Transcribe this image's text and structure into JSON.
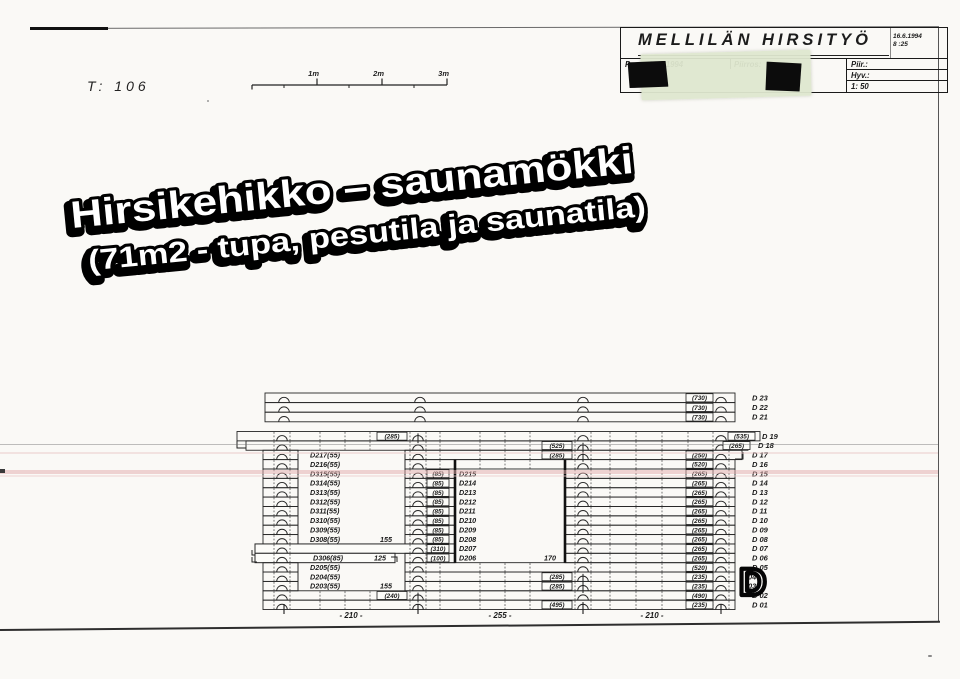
{
  "header": {
    "t_label": "T:  106",
    "scale_bar": {
      "labels": [
        "1m",
        "2m",
        "3m"
      ]
    },
    "title_block": {
      "company": "MELLILÄN HIRSITYÖ",
      "date": "16.6.1994",
      "time": "8 :25",
      "pvm_label": "Pvm.: 16.6.1994",
      "piirros_label": "Piirros:",
      "piir_label": "Piir.:",
      "hyv_label": "Hyv.:",
      "scale_label": "1: 50"
    }
  },
  "big_title": {
    "line1": "Hirsikehikko – saunamökki",
    "line2": "(71m2 - tupa, pesutila ja saunatila)"
  },
  "drawing": {
    "block": {
      "top": 431.5,
      "row_h": 9.37,
      "left": 263,
      "right": 735
    },
    "top_rows": {
      "top": 393,
      "row_h": 9.6,
      "left": 265,
      "right": 735,
      "arc_cols": [
        284,
        420,
        583,
        721
      ],
      "box_x": 686,
      "label_x": 752,
      "rows": [
        {
          "box": "(730)",
          "label": "D 23"
        },
        {
          "box": "(730)",
          "label": "D 22"
        },
        {
          "box": "(730)",
          "label": "D 21"
        }
      ]
    },
    "door": {
      "x1": 298,
      "x2": 405,
      "y1": 450.2,
      "y2": 590.8
    },
    "window": {
      "x1": 455,
      "x2": 565,
      "y1": 459.6,
      "y2": 562.7
    },
    "dims": {
      "ticks": [
        284,
        418,
        583,
        721
      ],
      "labels": [
        {
          "text": "- 210 -",
          "cx": 351
        },
        {
          "text": "- 255 -",
          "cx": 500
        },
        {
          "text": "- 210 -",
          "cx": 652
        }
      ]
    },
    "stamp": {
      "text": "D",
      "x": 739,
      "y": 595
    },
    "rows": [
      {
        "id": "D 19",
        "segs": [
          [
            237,
            760
          ]
        ],
        "arcs": [
          282,
          583,
          721
        ],
        "a": {
          "x": 418,
          "box": "(285)"
        },
        "right_box": {
          "text": "(535)",
          "x": 728
        },
        "label_x": 762,
        "dashes": [
          320,
          345,
          370,
          440,
          480,
          505,
          530,
          610,
          636,
          662,
          688
        ],
        "hooks": [
          [
            [
              237,
              441
            ],
            [
              237,
              448
            ],
            [
              246,
              448
            ]
          ]
        ]
      },
      {
        "id": "D 18",
        "segs": [
          [
            246,
            748
          ]
        ],
        "arcs": [
          282,
          418,
          721
        ],
        "a": {
          "x": 583,
          "box": "(525)"
        },
        "right_box": {
          "text": "(265)",
          "x": 723
        },
        "label_x": 758,
        "dashes": [
          320,
          345,
          370,
          440,
          480,
          505,
          530,
          610,
          636,
          662,
          688
        ]
      },
      {
        "id": "D 17",
        "segs": [
          [
            263,
            298
          ],
          [
            405,
            742
          ]
        ],
        "arcs": [
          282,
          418,
          721
        ],
        "a": {
          "x": 583,
          "box": "(285)"
        },
        "right_box": {
          "text": "(250)",
          "x": 686
        },
        "left_label": "D217(55)",
        "dashes": [
          440,
          480,
          505,
          530,
          610,
          636,
          662,
          688
        ],
        "hooks": [
          [
            [
              735,
              459
            ],
            [
              743,
              459
            ],
            [
              743,
              452
            ]
          ]
        ]
      },
      {
        "id": "D 16",
        "segs": [
          [
            263,
            298
          ],
          [
            405,
            735
          ]
        ],
        "arcs": [
          282,
          418,
          583,
          721
        ],
        "right_box": {
          "text": "(520)",
          "x": 686
        },
        "left_label": "D216(55)",
        "dashes": [
          440,
          480,
          505,
          530,
          610,
          636,
          662,
          688
        ]
      },
      {
        "id": "D 15",
        "segs": [
          [
            263,
            298
          ],
          [
            405,
            455
          ],
          [
            565,
            735
          ]
        ],
        "arcs": [
          282,
          418,
          583,
          721
        ],
        "right_box": {
          "text": "(265)",
          "x": 686
        },
        "left_label": "D315(55)",
        "mid_box": "(85)",
        "mid_label": "D215",
        "dashes": [
          610,
          636,
          662,
          688
        ]
      },
      {
        "id": "D 14",
        "segs": [
          [
            263,
            298
          ],
          [
            405,
            455
          ],
          [
            565,
            735
          ]
        ],
        "arcs": [
          282,
          418,
          583,
          721
        ],
        "right_box": {
          "text": "(265)",
          "x": 686
        },
        "left_label": "D314(55)",
        "mid_box": "(85)",
        "mid_label": "D214",
        "dashes": [
          610,
          636,
          662,
          688
        ]
      },
      {
        "id": "D 13",
        "segs": [
          [
            263,
            298
          ],
          [
            405,
            455
          ],
          [
            565,
            735
          ]
        ],
        "arcs": [
          282,
          418,
          583,
          721
        ],
        "right_box": {
          "text": "(265)",
          "x": 686
        },
        "left_label": "D313(55)",
        "mid_box": "(85)",
        "mid_label": "D213",
        "dashes": [
          610,
          636,
          662,
          688
        ]
      },
      {
        "id": "D 12",
        "segs": [
          [
            263,
            298
          ],
          [
            405,
            455
          ],
          [
            565,
            735
          ]
        ],
        "arcs": [
          282,
          418,
          583,
          721
        ],
        "right_box": {
          "text": "(265)",
          "x": 686
        },
        "left_label": "D312(55)",
        "mid_box": "(85)",
        "mid_label": "D212",
        "dashes": [
          610,
          636,
          662,
          688
        ]
      },
      {
        "id": "D 11",
        "segs": [
          [
            263,
            298
          ],
          [
            405,
            455
          ],
          [
            565,
            735
          ]
        ],
        "arcs": [
          282,
          418,
          583,
          721
        ],
        "right_box": {
          "text": "(265)",
          "x": 686
        },
        "left_label": "D311(55)",
        "mid_box": "(85)",
        "mid_label": "D211",
        "dashes": [
          610,
          636,
          662,
          688
        ]
      },
      {
        "id": "D 10",
        "segs": [
          [
            263,
            298
          ],
          [
            405,
            455
          ],
          [
            565,
            735
          ]
        ],
        "arcs": [
          282,
          418,
          583,
          721
        ],
        "right_box": {
          "text": "(265)",
          "x": 686
        },
        "left_label": "D310(55)",
        "mid_box": "(85)",
        "mid_label": "D210",
        "dashes": [
          610,
          636,
          662,
          688
        ]
      },
      {
        "id": "D 09",
        "segs": [
          [
            263,
            298
          ],
          [
            405,
            455
          ],
          [
            565,
            735
          ]
        ],
        "arcs": [
          282,
          418,
          583,
          721
        ],
        "right_box": {
          "text": "(265)",
          "x": 686
        },
        "left_label": "D309(55)",
        "mid_box": "(85)",
        "mid_label": "D209",
        "dashes": [
          610,
          636,
          662,
          688
        ]
      },
      {
        "id": "D 08",
        "segs": [
          [
            263,
            298
          ],
          [
            405,
            455
          ],
          [
            565,
            735
          ]
        ],
        "arcs": [
          282,
          418,
          583,
          721
        ],
        "right_box": {
          "text": "(265)",
          "x": 686
        },
        "left_label": "D308(55)",
        "left_dim": {
          "text": "155",
          "x": 392
        },
        "mid_box": "(85)",
        "mid_label": "D208",
        "dashes": [
          610,
          636,
          662,
          688
        ]
      },
      {
        "id": "D 07",
        "segs": [
          [
            255,
            455
          ],
          [
            565,
            735
          ]
        ],
        "bar": 0,
        "arcs": [
          282,
          418,
          583,
          721
        ],
        "right_box": {
          "text": "(265)",
          "x": 686
        },
        "mid_box": "(310)",
        "mid_label": "D207",
        "dashes": [
          610,
          636,
          662,
          688
        ],
        "hooks": [
          [
            [
              252,
              550
            ],
            [
              252,
              555
            ],
            [
              256,
              555
            ]
          ]
        ]
      },
      {
        "id": "D 06",
        "segs": [
          [
            255,
            395
          ],
          [
            405,
            455
          ],
          [
            565,
            735
          ]
        ],
        "bar": 0,
        "arcs": [
          282,
          418,
          583,
          721
        ],
        "right_box": {
          "text": "(265)",
          "x": 686
        },
        "left_label": "D306(85)",
        "left_label_x": 313,
        "left_dim": {
          "text": "125",
          "x": 386
        },
        "mid_box": "(100)",
        "mid_label": "D206",
        "win_dim": {
          "text": "170",
          "x": 556
        },
        "dashes": [
          610,
          636,
          662,
          688
        ],
        "hooks": [
          [
            [
              391,
              557
            ],
            [
              397,
              557
            ],
            [
              397,
              562
            ]
          ],
          [
            [
              252,
              557
            ],
            [
              252,
              562
            ],
            [
              257,
              562
            ]
          ]
        ]
      },
      {
        "id": "D 05",
        "segs": [
          [
            263,
            298
          ],
          [
            405,
            735
          ]
        ],
        "arcs": [
          282,
          418,
          583,
          721
        ],
        "right_box": {
          "text": "(520)",
          "x": 686
        },
        "left_label": "D205(55)",
        "dashes": [
          440,
          480,
          505,
          530,
          610,
          636,
          662,
          688
        ]
      },
      {
        "id": "04",
        "segs": [
          [
            263,
            298
          ],
          [
            405,
            735
          ]
        ],
        "arcs": [
          282,
          418,
          721
        ],
        "a": {
          "x": 583,
          "box": "(285)"
        },
        "right_box": {
          "text": "(235)",
          "x": 686
        },
        "label_x": 748,
        "left_label": "D204(55)",
        "dashes": [
          440,
          480,
          505,
          530,
          610,
          636,
          662,
          688
        ]
      },
      {
        "id": "03",
        "segs": [
          [
            263,
            298
          ],
          [
            405,
            735
          ]
        ],
        "arcs": [
          282,
          418,
          721
        ],
        "a": {
          "x": 583,
          "box": "(285)"
        },
        "right_box": {
          "text": "(235)",
          "x": 686
        },
        "label_x": 748,
        "left_label": "D203(55)",
        "left_dim": {
          "text": "155",
          "x": 392
        },
        "dashes": [
          440,
          480,
          505,
          530,
          610,
          636,
          662,
          688
        ]
      },
      {
        "id": "D 02",
        "segs": [
          [
            263,
            735
          ]
        ],
        "arcs": [
          282,
          583,
          721
        ],
        "a": {
          "x": 418,
          "box": "(240)"
        },
        "right_box": {
          "text": "(490)",
          "x": 686
        },
        "dashes": [
          320,
          345,
          370,
          440,
          480,
          505,
          530,
          610,
          636,
          662,
          688
        ]
      },
      {
        "id": "D 01",
        "segs": [
          [
            263,
            735
          ]
        ],
        "arcs": [
          282,
          418,
          721
        ],
        "a": {
          "x": 583,
          "box": "(495)"
        },
        "right_box": {
          "text": "(235)",
          "x": 686
        },
        "dashes": [
          320,
          345,
          370,
          440,
          480,
          505,
          530,
          610,
          636,
          662,
          688
        ]
      }
    ]
  }
}
